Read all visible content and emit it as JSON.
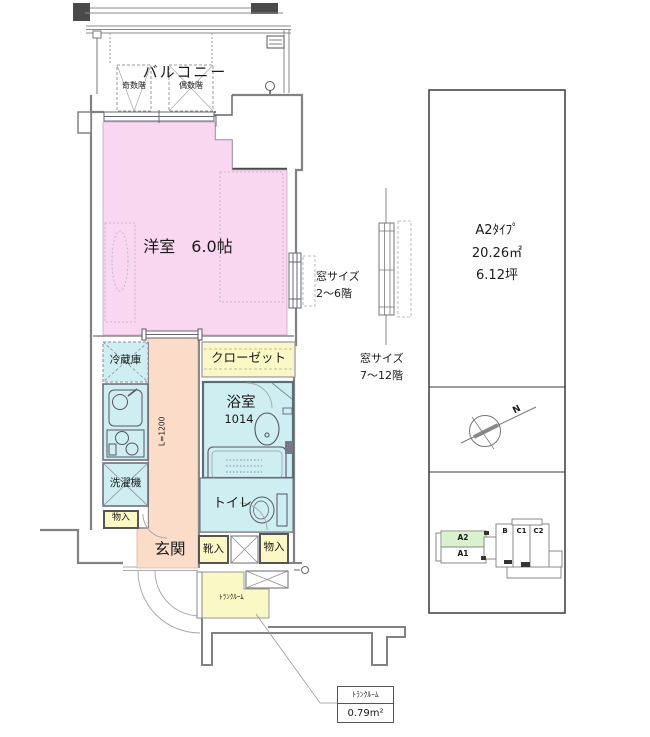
{
  "balcony": {
    "label": "バルコニー",
    "odd_floors": "奇数階",
    "even_floors": "偶数階"
  },
  "rooms": {
    "living": "洋室　6.0帖",
    "fridge": "冷蔵庫",
    "closet": "クローゼット",
    "bath": "浴室",
    "bath_size": "1014",
    "washer": "洗濯機",
    "storage_left": "物入",
    "toilet": "トイレ",
    "entrance": "玄関",
    "shoes": "靴入",
    "storage_right": "物入",
    "trunk": "ﾄﾗﾝｸﾙｰﾑ",
    "hall_width": "L=1200"
  },
  "window_notes": {
    "low": {
      "line1": "窓サイズ",
      "line2": "2～6階"
    },
    "high": {
      "line1": "窓サイズ",
      "line2": "7～12階"
    }
  },
  "callout": {
    "name": "ﾄﾗﾝｸﾙｰﾑ",
    "area": "0.79m²"
  },
  "info_panel": {
    "type_name": "A2ﾀｲﾌﾟ",
    "area_sqm": "20.26㎡",
    "area_tsubo": "6.12坪",
    "compass_north": "N",
    "key_plan": {
      "a2": "A2",
      "a1": "A1",
      "b": "B",
      "c1": "C1",
      "c2": "C2"
    }
  },
  "colors": {
    "room_pink": "#f9d7f0",
    "hall_salmon": "#fadcc8",
    "wet_cyan": "#cfeef2",
    "storage_yellow": "#faf8c4",
    "keyplan_green": "#d9f2cc",
    "wall_gray": "#828282",
    "dark_wall": "#4a4a4a"
  }
}
